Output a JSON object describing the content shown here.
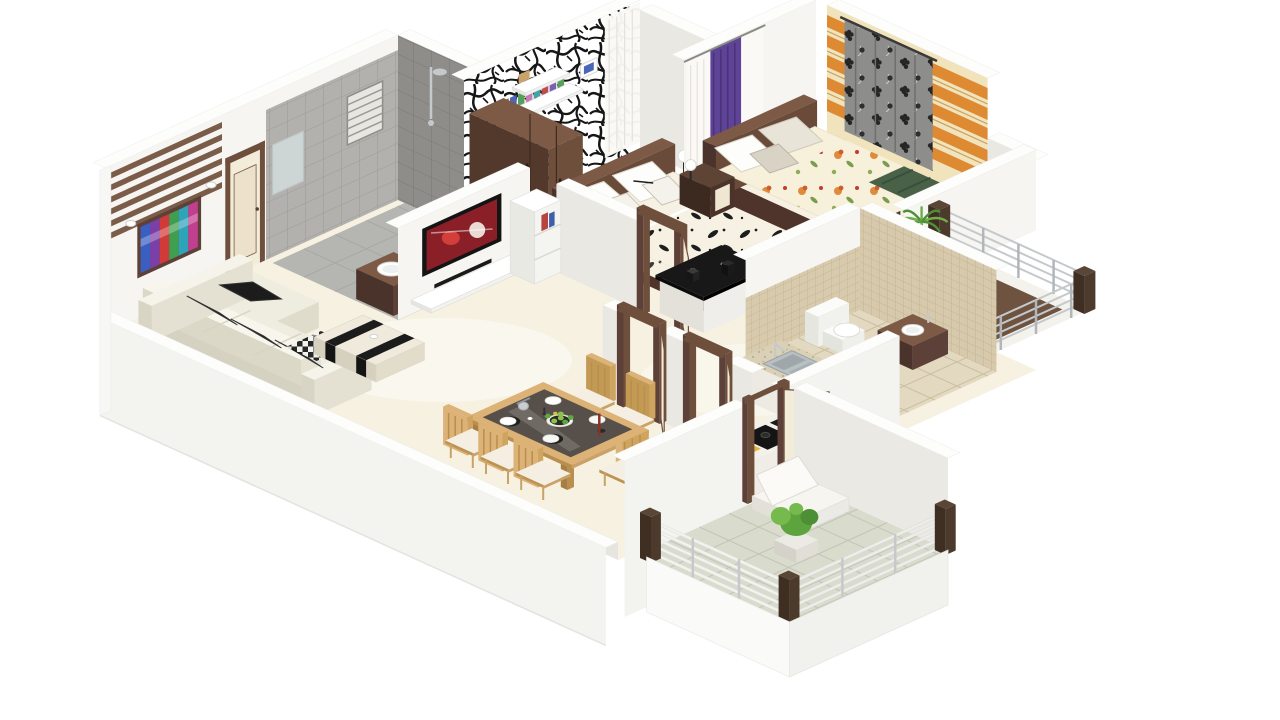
{
  "scene": {
    "type": "3d-floor-plan",
    "layout": "two-bedroom-apartment",
    "view": "isometric-cutaway",
    "description": "3D isometric cutaway floor plan render of a two-bedroom apartment on a white background"
  },
  "palette": {
    "background": "#ffffff",
    "wall_top": "#fdfdfc",
    "wall_se": "#f6f5f1",
    "wall_sw": "#eae8e2",
    "wall_outer": "#f3f3f0",
    "wall_inner": "#e7e5df",
    "floor_marble": "#f6f1e0",
    "floor_tan": "#d8c59e",
    "floor_gray": "#b5b5b1",
    "floor_balcony": "#d9dbcd",
    "floor_beige": "#e3d9c0",
    "tile_gray": "#b3b1ad",
    "tile_gray_dark": "#8f8d89",
    "tile_beige": "#d8cbad",
    "wood_dark": "#5d4037",
    "wood_mid": "#6e4f3c",
    "wood_light": "#7d5a45",
    "slat_brown": "#7a5c49",
    "door_cream": "#f3ecd9",
    "sofa_cream": "#efece0",
    "sofa_shade": "#e0dccb",
    "cushion_black": "#1c1c1c",
    "tv_black": "#141414",
    "screen_red": "#8a1f28",
    "bed_frame": "#5d4037",
    "bed_frame_dark": "#4e342a",
    "bed_linen": "#f6f1e2",
    "pillow_white": "#fdfdfb",
    "throw_green": "#4a6148",
    "curtain_purple": "#5f4396",
    "curtain_sheer": "#faf9f5",
    "curtain_gray": "#8d8d8b",
    "wall_cream": "#f1e3bb",
    "stripe_orange": "#dd8a33",
    "counter_black": "#181818",
    "counter_speckle": "#d9d0b6",
    "steel": "#b9c0c4",
    "appliance_gray": "#9aa0a2",
    "burner_red": "#c62f2f",
    "chair_wood": "#dcb276",
    "chair_wood_dark": "#caa268",
    "fruit_green": "#8bc34a",
    "plant_green": "#5da33e",
    "plant_light": "#76b94d",
    "palm_green": "#4f8f3a",
    "pot_white": "#eceae4",
    "rail_silver": "#c5c9cc",
    "post_brown": "#5a4636",
    "painting_frame": "#5d4037",
    "painting_colors": [
      "#3a5fc0",
      "#7b3fa8",
      "#d23a3a",
      "#3f9e4f",
      "#2fa3b8",
      "#c23f8f"
    ],
    "book_colors": [
      "#c14b4b",
      "#4b66b8",
      "#56a05a",
      "#c77bb0",
      "#3fa3a8",
      "#c14b4b",
      "#7b5fb0",
      "#56a05a"
    ]
  },
  "rooms": [
    {
      "name": "living-room",
      "items": [
        "l-shaped-cream-sofa",
        "black-cushions",
        "coffee-table",
        "checkered-rug",
        "abstract-wall-art",
        "wood-slat-wall-panel",
        "wall-lamps",
        "entry-door",
        "tv-unit",
        "ladder-shelf"
      ]
    },
    {
      "name": "bathroom-1",
      "items": [
        "vanity-washbasin",
        "mirror",
        "toilet",
        "shower",
        "louver-window",
        "gray-wall-tiles"
      ]
    },
    {
      "name": "bedroom-1",
      "items": [
        "double-bed-black-floral-bedding",
        "wardrobe",
        "book-shelf",
        "black-white-feature-wall",
        "sheer-curtain",
        "bedside-lamp",
        "open-door"
      ]
    },
    {
      "name": "bedroom-2",
      "items": [
        "double-bed-floral-bedding",
        "green-throw",
        "headboard",
        "nightstand",
        "bedside-lamp",
        "purple-curtain",
        "sheer-curtains",
        "orange-striped-feature-wall",
        "gray-floral-curtain",
        "dark-wall-panel"
      ]
    },
    {
      "name": "hallway",
      "items": [
        "black-top-counter",
        "door-frames",
        "open-doors"
      ]
    },
    {
      "name": "dining-area",
      "items": [
        "six-seater-wood-table",
        "dark-glass-top",
        "dinner-plates",
        "fruit-bowl",
        "candle-stand",
        "kettle",
        "wooden-chairs"
      ]
    },
    {
      "name": "kitchen",
      "items": [
        "counter",
        "stainless-sink",
        "faucet",
        "cooktop-red-burners",
        "gas-hob",
        "under-counter-appliance",
        "cutting-board"
      ]
    },
    {
      "name": "bathroom-2",
      "items": [
        "toilet",
        "round-countertop-basin",
        "beige-mosaic-tiles"
      ]
    },
    {
      "name": "balcony-right",
      "items": [
        "chrome-railing",
        "palm-plant",
        "brown-floor-mat"
      ]
    },
    {
      "name": "balcony-bottom",
      "items": [
        "white-slat-railing",
        "wood-posts",
        "potted-plant",
        "lounge-chair",
        "gray-tile-floor"
      ]
    }
  ]
}
